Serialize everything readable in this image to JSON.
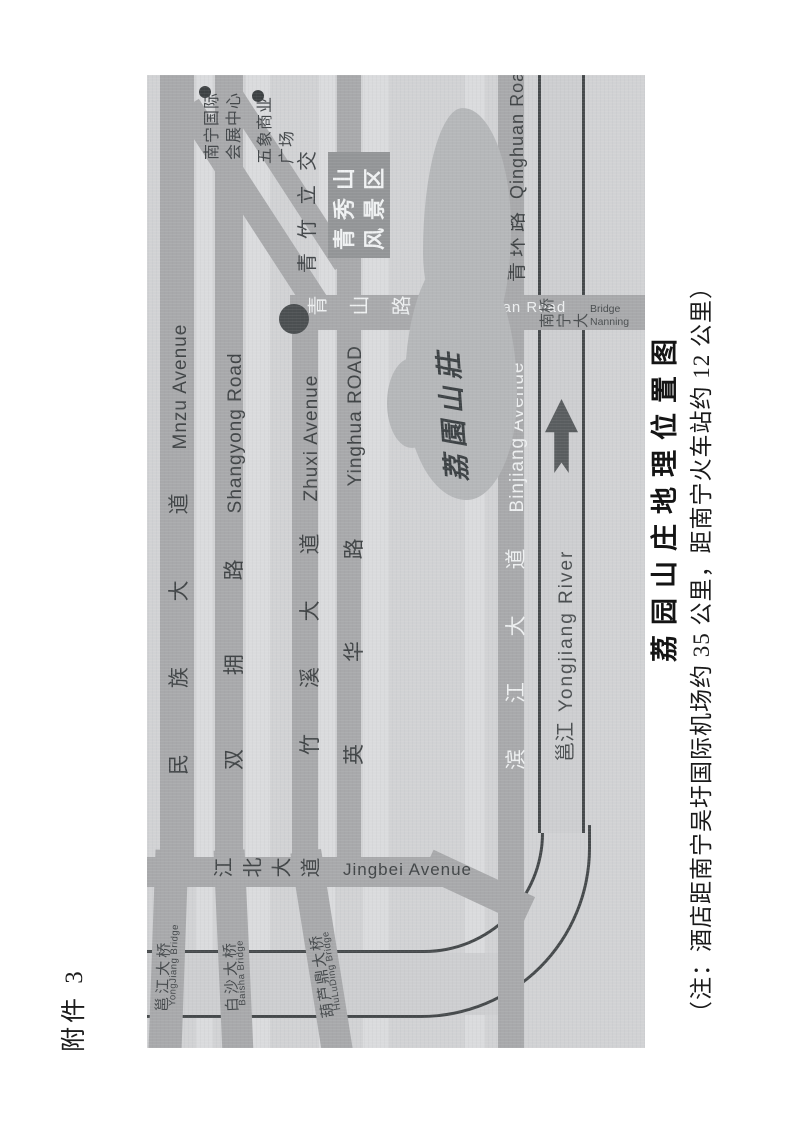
{
  "page": {
    "attachment_label": "附件 3",
    "caption": "荔园山庄地理位置图",
    "note": "（注：酒店距南宁吴圩国际机场约 35 公里，距南宁火车站约 12 公里）"
  },
  "map": {
    "roads": {
      "minzu": {
        "zh": "民 族 大 道",
        "en": "Mnzu Avenue"
      },
      "shangyong": {
        "zh": "双 拥 路",
        "en": "Shangyong Road"
      },
      "zhuxi": {
        "zh": "竹 溪 大 道",
        "en": "Zhuxi Avenue"
      },
      "yinghua": {
        "zh": "英 华 路",
        "en": "Yinghua ROAD"
      },
      "binjiang": {
        "zh": "滨 江 大 道",
        "en": "Binjiang Avenue"
      },
      "qinghuan": {
        "zh": "青环路",
        "en": "Qinghuan Road"
      },
      "jingbei": {
        "zh": "江北大道",
        "en": "Jingbei Avenue"
      },
      "qingshan": {
        "zh": "青山路",
        "en": "Qingshan Road"
      }
    },
    "river": {
      "zh": "邕江",
      "en": "Yongjiang River"
    },
    "bridges": {
      "yongjiang": {
        "zh": "邕江大桥",
        "en": "YongJiang Bridge"
      },
      "baisha": {
        "zh": "白沙大桥",
        "en": "Baisha Bridge"
      },
      "huluding": {
        "zh": "葫芦鼎大桥",
        "en": "HuLuDing Bridge"
      },
      "nanning": {
        "zh": "南宁大桥",
        "en": "Nanning Bridge"
      }
    },
    "landmarks": {
      "convention": {
        "line1": "南宁国际",
        "line2": "会展中心"
      },
      "wuxiang": {
        "line1": "五象商业",
        "line2": "广场"
      },
      "interchange": "青竹立交",
      "scenic": {
        "line1": "青秀山",
        "line2": "风景区"
      },
      "villa": "荔園山莊"
    },
    "colors": {
      "map_bg": "#d1d2d4",
      "road": "#a8a9ab",
      "river_line": "#45494b",
      "scenic_box": "#939597",
      "villa_blob": "#b5b7b9",
      "dark_text": "#404446",
      "light_text": "#eef0f1"
    }
  }
}
